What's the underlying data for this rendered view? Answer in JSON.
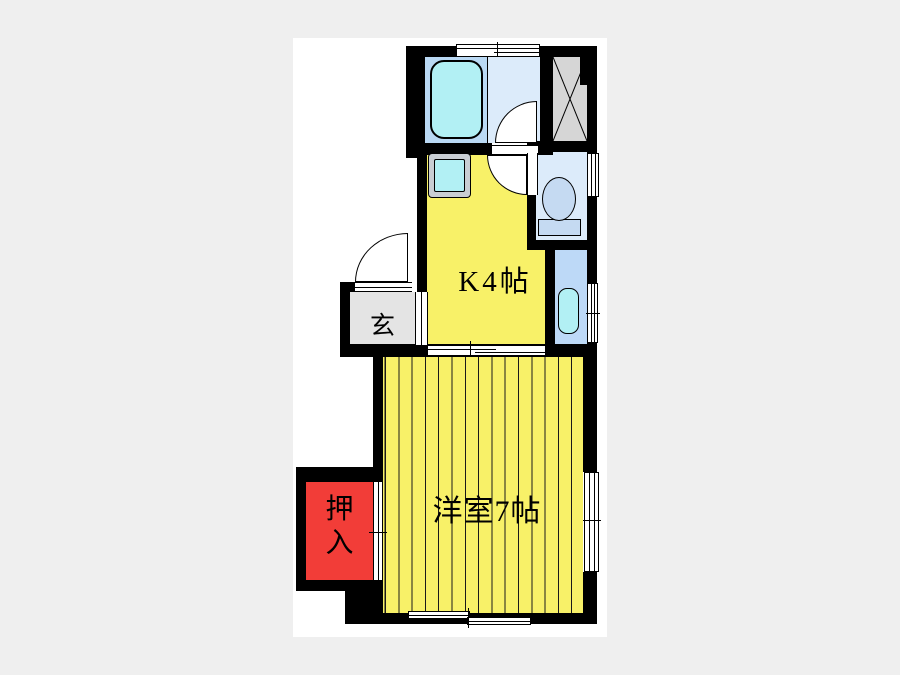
{
  "page": {
    "background_color": "#efefef",
    "canvas_color": "#ffffff"
  },
  "floorplan": {
    "type": "japanese-apartment-floorplan",
    "wall_color": "#000000",
    "labels": {
      "kitchen": "K4帖",
      "western_room": "洋室7帖",
      "entrance": "玄",
      "closet_line1": "押",
      "closet_line2": "入"
    },
    "rooms": [
      {
        "id": "kitchen",
        "label": "K4帖",
        "floor_color": "#f8f168"
      },
      {
        "id": "western-room",
        "label": "洋室7帖",
        "floor_color": "#f8f168",
        "floor_pattern": "vertical-plank-stripes"
      },
      {
        "id": "entrance-genkan",
        "label": "玄",
        "floor_color": "#e4e4e4"
      },
      {
        "id": "closet-oshiire",
        "label": "押入",
        "floor_color": "#f23d38"
      },
      {
        "id": "bathroom",
        "label": "",
        "floor_colors": [
          "#bad9f4",
          "#dcebfa"
        ]
      },
      {
        "id": "toilet-room",
        "label": "",
        "floor_color": "#dcebfa"
      },
      {
        "id": "wash-area",
        "label": "",
        "floor_color": "#bdd9f7"
      },
      {
        "id": "pipe-shaft",
        "label": "",
        "floor_color": "#d6d6d6",
        "marking": "X"
      }
    ],
    "fixtures": [
      {
        "id": "bathtub",
        "color": "#b2f0f4"
      },
      {
        "id": "kitchen-sink",
        "color": "#b2f0f4",
        "frame_color": "#c9ced3"
      },
      {
        "id": "toilet",
        "color": "#c5daf2"
      },
      {
        "id": "wash-basin",
        "color": "#b2f0f4"
      }
    ],
    "openings": [
      "entrance-swing-door",
      "bathroom-swing-door",
      "toilet-swing-door",
      "kitchen-room-sliding-door",
      "closet-sliding-door",
      "top-window",
      "toilet-window",
      "wash-window",
      "room-side-window",
      "room-bottom-window"
    ]
  }
}
